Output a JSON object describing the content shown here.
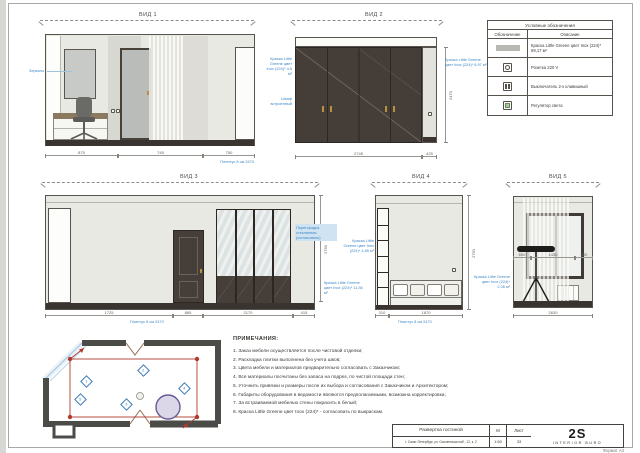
{
  "page": {
    "format_label": "Формат А3"
  },
  "views": {
    "v1": {
      "title": "ВИД 1",
      "ann_mirror": "Зеркало",
      "ann_plinth": "Плинтус 8 см 2470",
      "dims": [
        "875",
        "745",
        "750"
      ]
    },
    "v2": {
      "title": "ВИД 2",
      "ann_paint_left": "Краска Little Greene цвет Inox (224)* 4,5 м²",
      "ann_cabinet": "Шкаф встроенный",
      "ann_paint_right": "Краска Little Greene цвет Inox (224)* 6,97 м²",
      "dim_height": "2470",
      "dims": [
        "2745",
        "425"
      ]
    },
    "v3": {
      "title": "ВИД 3",
      "ann_glass": "Перегородка стеклянная (согласовать)",
      "ann_paint": "Краска Little Greene цвет Inox (224)* 11,36 м²",
      "ann_plinth": "Плинтус 8 см 2470",
      "dim_height": "2750",
      "dims": [
        "1725",
        "885",
        "2170",
        "415"
      ]
    },
    "v4": {
      "title": "ВИД 4",
      "ann_paint_left": "Краска Little Greene цвет Inox (224)* 4,85 м²",
      "ann_plinth": "Плинтус 8 см 2470",
      "dim_height": "2750",
      "dims": [
        "310",
        "1870"
      ]
    },
    "v5": {
      "title": "ВИД 5",
      "ann_paint": "Краска Little Greene цвет Inox (224)* 2,06 м²",
      "dims_inner": [
        "600",
        "1430",
        "600"
      ],
      "dim_bottom": "2630"
    }
  },
  "legend": {
    "title": "Условные обозначения",
    "col_symbol": "Обозначение",
    "col_desc": "Описание",
    "rows": [
      {
        "icon": "paint-swatch",
        "desc": "Краска Little Greene цвет Inox (224)* 69,17 м²"
      },
      {
        "icon": "socket-icon",
        "desc": "Розетка 220 V"
      },
      {
        "icon": "switch-icon",
        "desc": "Выключатель 2-х клавишный"
      },
      {
        "icon": "dimmer-icon",
        "desc": "Регулятор света"
      }
    ]
  },
  "notes": {
    "title": "ПРИМЕЧАНИЯ:",
    "items": [
      "1. Заказ мебели осуществляется после чистовой отделки;",
      "2. Раскладка плитки выполнена без учета швов;",
      "3. Цвета мебели и материалов предварительно согласовать с Заказчиком;",
      "4. Все материалы посчитаны без запаса на подрез, по чистой площади стен;",
      "5. Уточнить привязки и размеры после их выбора и согласования с Заказчиком и Архитектором;",
      "6. Габариты оборудования в ведомости являются предполагаемыми, возможна корректировка;",
      "7. За встраиваемой мебелью стены покрасить в белый;",
      "8. Краска Little Greene цвет Inox (224)* - согласовать по выкраскам."
    ]
  },
  "plan": {
    "markers": [
      "1",
      "2",
      "3",
      "4",
      "5"
    ]
  },
  "titleblock": {
    "project": "Развертка гостиной",
    "address": "г. Санкт-Петербург, ул. Смоленская наб., 12, к. 2",
    "scale_label": "М",
    "scale": "1:50",
    "sheet_label": "Лист",
    "sheet": "33",
    "logo": "2S",
    "logo_sub": "INTERIOR BURO"
  },
  "colors": {
    "annotation_blue": "#3f87c6",
    "marker_red": "#b03a2e",
    "wood_dark": "#443d38",
    "gold": "#b8913f",
    "plan_purple": "#6b5b95",
    "legend_green": "#a9c89b"
  }
}
